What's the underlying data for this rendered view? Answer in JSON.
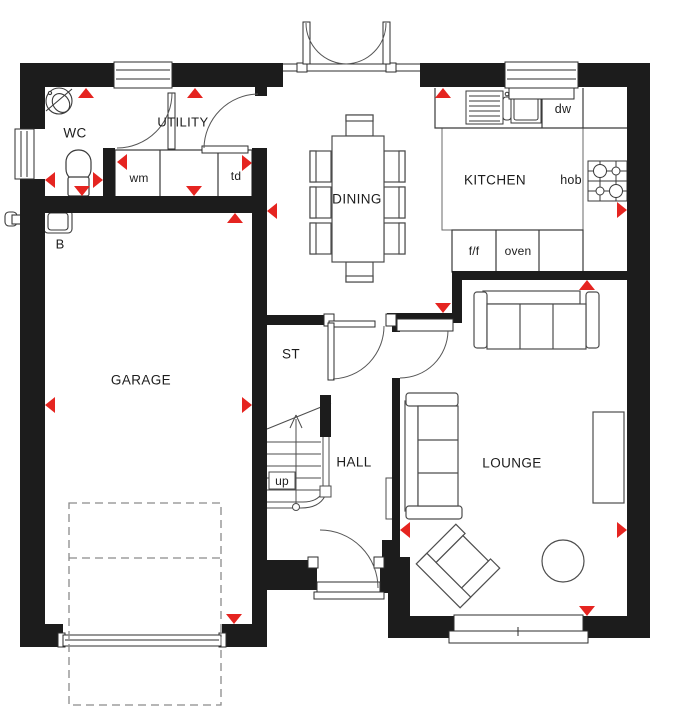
{
  "plan_type": "ground-floor-plan",
  "colors": {
    "wall": "#1c1c1c",
    "marker_red": "#e52420",
    "line": "#4d4d4d",
    "background": "#ffffff"
  },
  "rooms": {
    "wc": {
      "label": "WC"
    },
    "utility": {
      "label": "UTILITY",
      "washing_machine": "wm",
      "tumble_dryer": "td"
    },
    "dining": {
      "label": "DINING"
    },
    "kitchen": {
      "label": "KITCHEN",
      "dishwasher": "dw",
      "hob": "hob",
      "fridge_freezer": "f/f",
      "oven": "oven"
    },
    "garage": {
      "label": "GARAGE",
      "boiler": "B"
    },
    "store": {
      "label": "ST"
    },
    "hall": {
      "label": "HALL",
      "stairs_direction": "up"
    },
    "lounge": {
      "label": "LOUNGE"
    }
  },
  "markers": {
    "shape": "red-triangle",
    "count": 20
  }
}
